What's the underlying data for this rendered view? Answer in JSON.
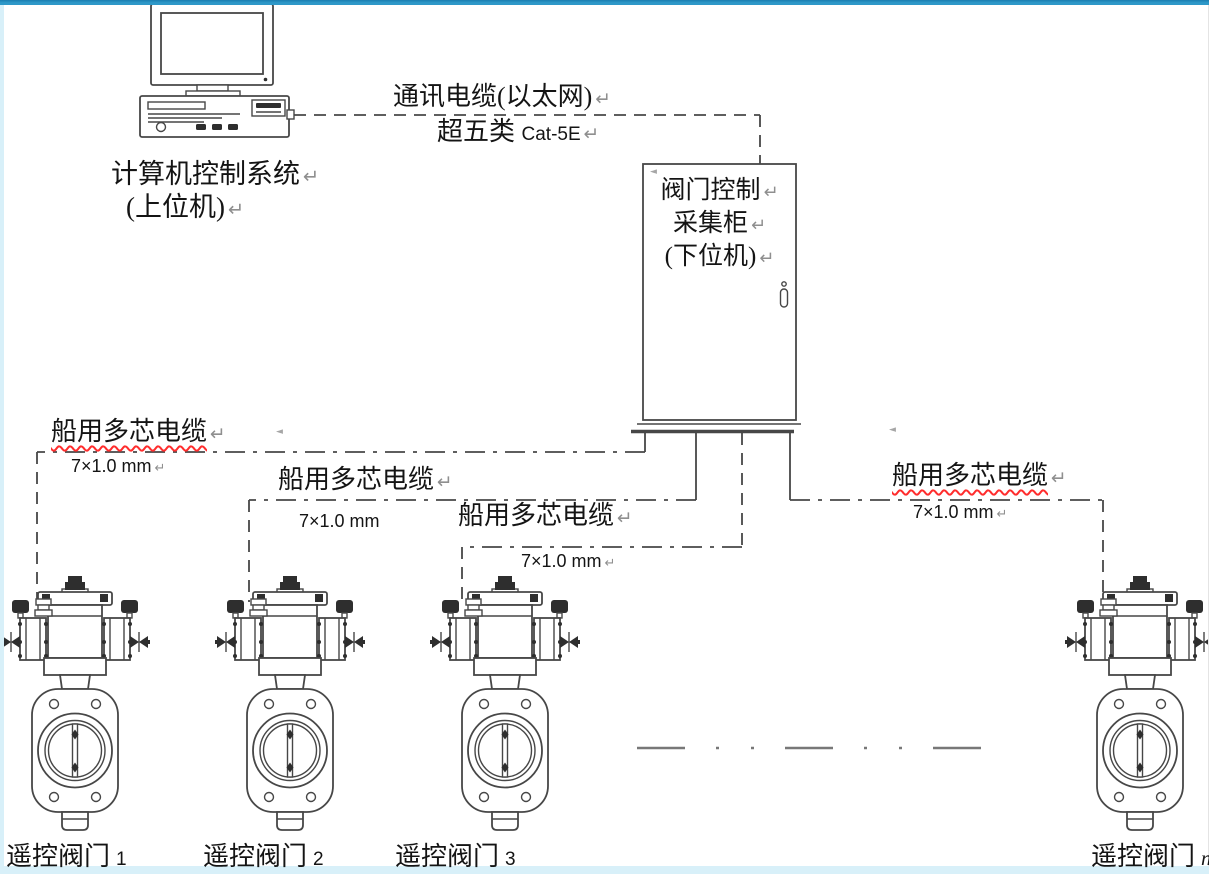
{
  "colors": {
    "top_bar": "#2e98c8",
    "top_bar_edge": "#1b7db0",
    "edge_strip": "#d8f0f9",
    "line": "#474747",
    "ink": "#2e2e2e",
    "text": "#141414",
    "mark": "#8f8f8f",
    "squiggle": "#ff2d2d",
    "cont_line": "#787878",
    "bg": "#ffffff"
  },
  "marks": {
    "pilcrow": "↵",
    "anchor": "◄"
  },
  "computer": {
    "line1": "计算机控制系统",
    "line2": "(上位机)"
  },
  "comm_cable": {
    "line1": "通讯电缆(以太网)",
    "line2_cn": "超五类",
    "line2_en": "Cat-5E"
  },
  "cabinet": {
    "line1": "阀门控制",
    "line2": "采集柜",
    "line3": "(下位机)"
  },
  "marine_cables": {
    "items": [
      {
        "name": "船用多芯电缆",
        "spec": "7×1.0 mm"
      },
      {
        "name": "船用多芯电缆",
        "spec": "7×1.0 mm"
      },
      {
        "name": "船用多芯电缆",
        "spec": "7×1.0 mm"
      },
      {
        "name": "船用多芯电缆",
        "spec": "7×1.0 mm"
      }
    ]
  },
  "valves": {
    "items": [
      {
        "label": "遥控阀门",
        "num": "1"
      },
      {
        "label": "遥控阀门",
        "num": "2"
      },
      {
        "label": "遥控阀门",
        "num": "3"
      },
      {
        "label": "遥控阀门",
        "num": "n"
      }
    ]
  }
}
